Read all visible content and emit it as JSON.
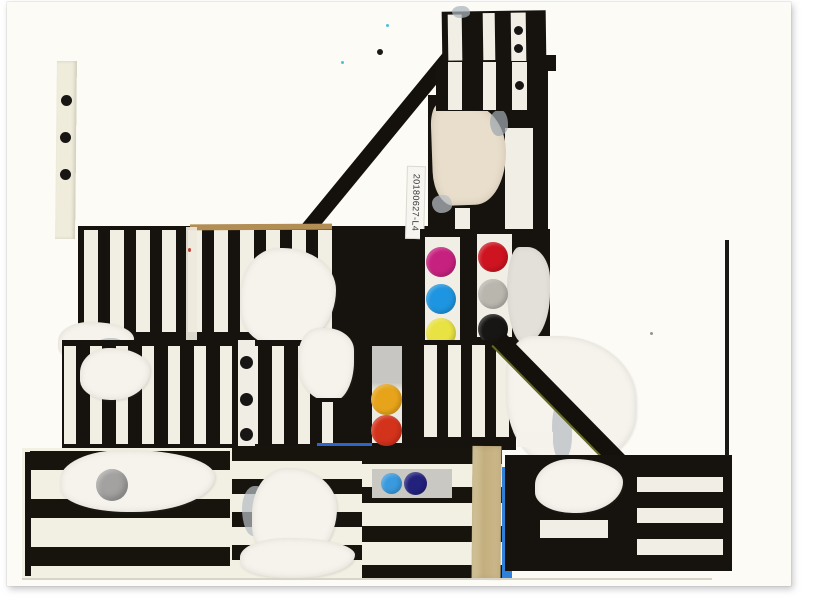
{
  "artwork": {
    "medium": "black-and-white striped paper collage with dot stickers (scan)",
    "label": {
      "text": "20180627-L4"
    },
    "palette": {
      "ink": "#16130e",
      "cream": "#f2efe3",
      "paper": "#fcfbf6",
      "white_torn": "#f5f3ec",
      "beige": "#e8decb",
      "tan": "#c8b482",
      "cream_strip": "#f0ecdc",
      "magenta": "#c6217e",
      "red": "#ce1420",
      "cyan": "#1e95e0",
      "gray": "#b9b6ae",
      "yellow": "#e9e243",
      "black_dot": "#181614",
      "orange": "#e7a41b",
      "orange_red": "#d3321b",
      "sky_blue": "#3a9ade",
      "navy": "#22217c",
      "silver": "#a3a2a0",
      "azure": "#2e80d8",
      "blue_dash": "#2b66c8"
    },
    "stickers": {
      "left_column": [
        "magenta",
        "cyan",
        "yellow"
      ],
      "right_column": [
        "red",
        "gray",
        "black_dot"
      ],
      "middle_pair": [
        "orange",
        "orange_red"
      ],
      "bottom_pair": [
        "sky_blue",
        "navy"
      ],
      "single": [
        "silver"
      ],
      "small_black_dot_count": 9
    }
  }
}
